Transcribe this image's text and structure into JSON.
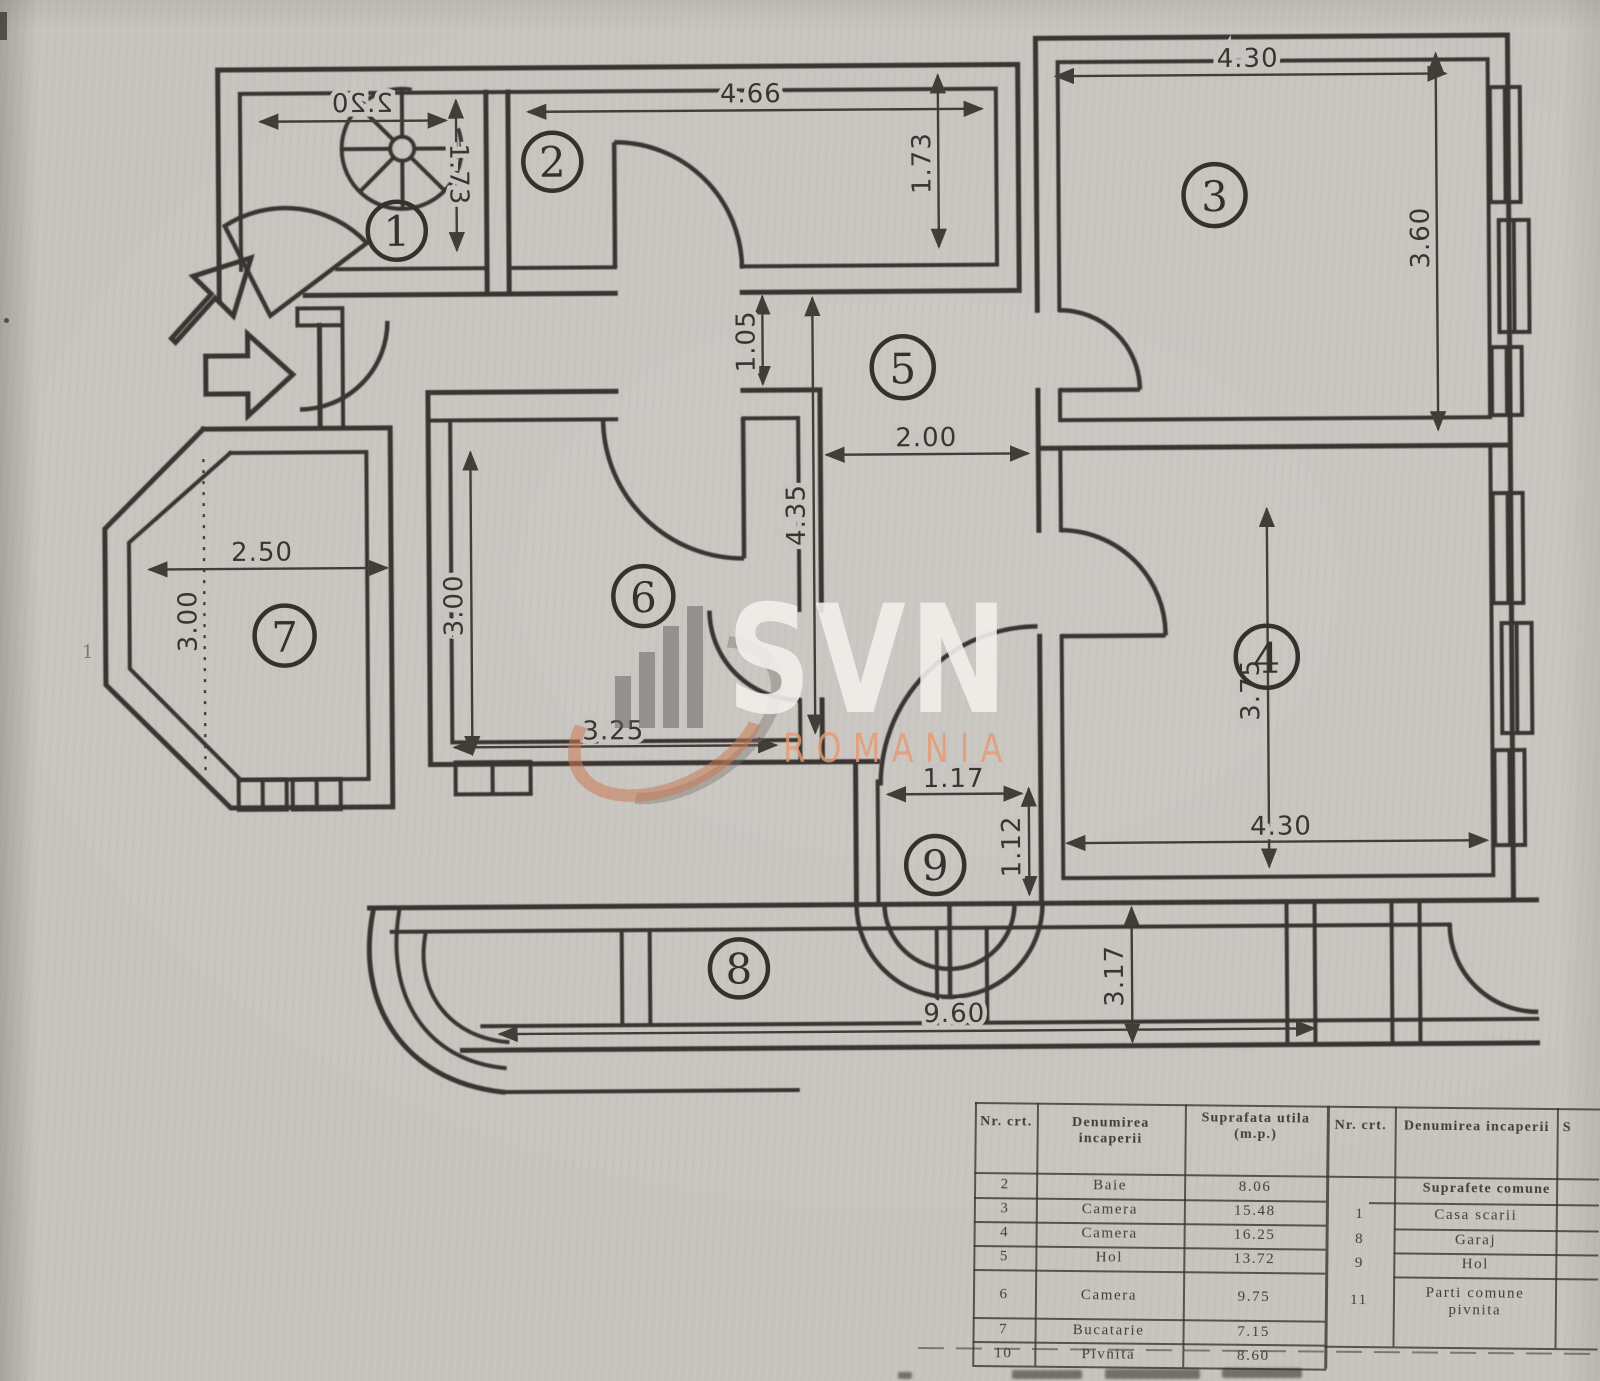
{
  "plan": {
    "rooms": {
      "r1": "1",
      "r2": "2",
      "r3": "3",
      "r4": "4",
      "r5": "5",
      "r6": "6",
      "r7": "7",
      "r8": "8",
      "r9": "9"
    },
    "dims": {
      "room1_w": "2.20",
      "room1_h": "1.73",
      "room2_w": "4.66",
      "room2_h": "1.73",
      "room3_w": "4.30",
      "room3_h": "3.60",
      "pass_h": "1.05",
      "hall_w": "2.00",
      "hall_h": "4.35",
      "room7_w": "2.50",
      "room7_h": "3.00",
      "room6_h": "3.00",
      "room6_w": "3.25",
      "room4_h": "3.75",
      "room4_w": "4.30",
      "room9_w": "1.17",
      "room9_h": "1.12",
      "back_h": "3.17",
      "strip_w": "9.60"
    },
    "stray_mark": "1"
  },
  "watermark": {
    "name": "SVN",
    "sub": "ROMANIA",
    "accent": "#cb7b54",
    "letters": "#f0eeea"
  },
  "table": {
    "headers": {
      "nr": "Nr. crt.",
      "name": "Denumirea incaperii",
      "area": "Suprafata utila (m.p.)",
      "nr2": "Nr. crt.",
      "name2": "Denumirea incaperii",
      "area2": "S"
    },
    "common_span": "Suprafete comune",
    "left_rows": [
      {
        "nr": "2",
        "name": "Baie",
        "area": "8.06"
      },
      {
        "nr": "3",
        "name": "Camera",
        "area": "15.48"
      },
      {
        "nr": "4",
        "name": "Camera",
        "area": "16.25"
      },
      {
        "nr": "5",
        "name": "Hol",
        "area": "13.72"
      },
      {
        "nr": "6",
        "name": "Camera",
        "area": "9.75"
      },
      {
        "nr": "7",
        "name": "Bucatarie",
        "area": "7.15"
      },
      {
        "nr": "10",
        "name": "Pivnita",
        "area": "8.60"
      }
    ],
    "right_rows": [
      {
        "nr": "1",
        "name": "Casa scarii"
      },
      {
        "nr": "8",
        "name": "Garaj"
      },
      {
        "nr": "9",
        "name": "Hol"
      },
      {
        "nr": "11",
        "name": "Parti comune pivnita"
      }
    ]
  }
}
